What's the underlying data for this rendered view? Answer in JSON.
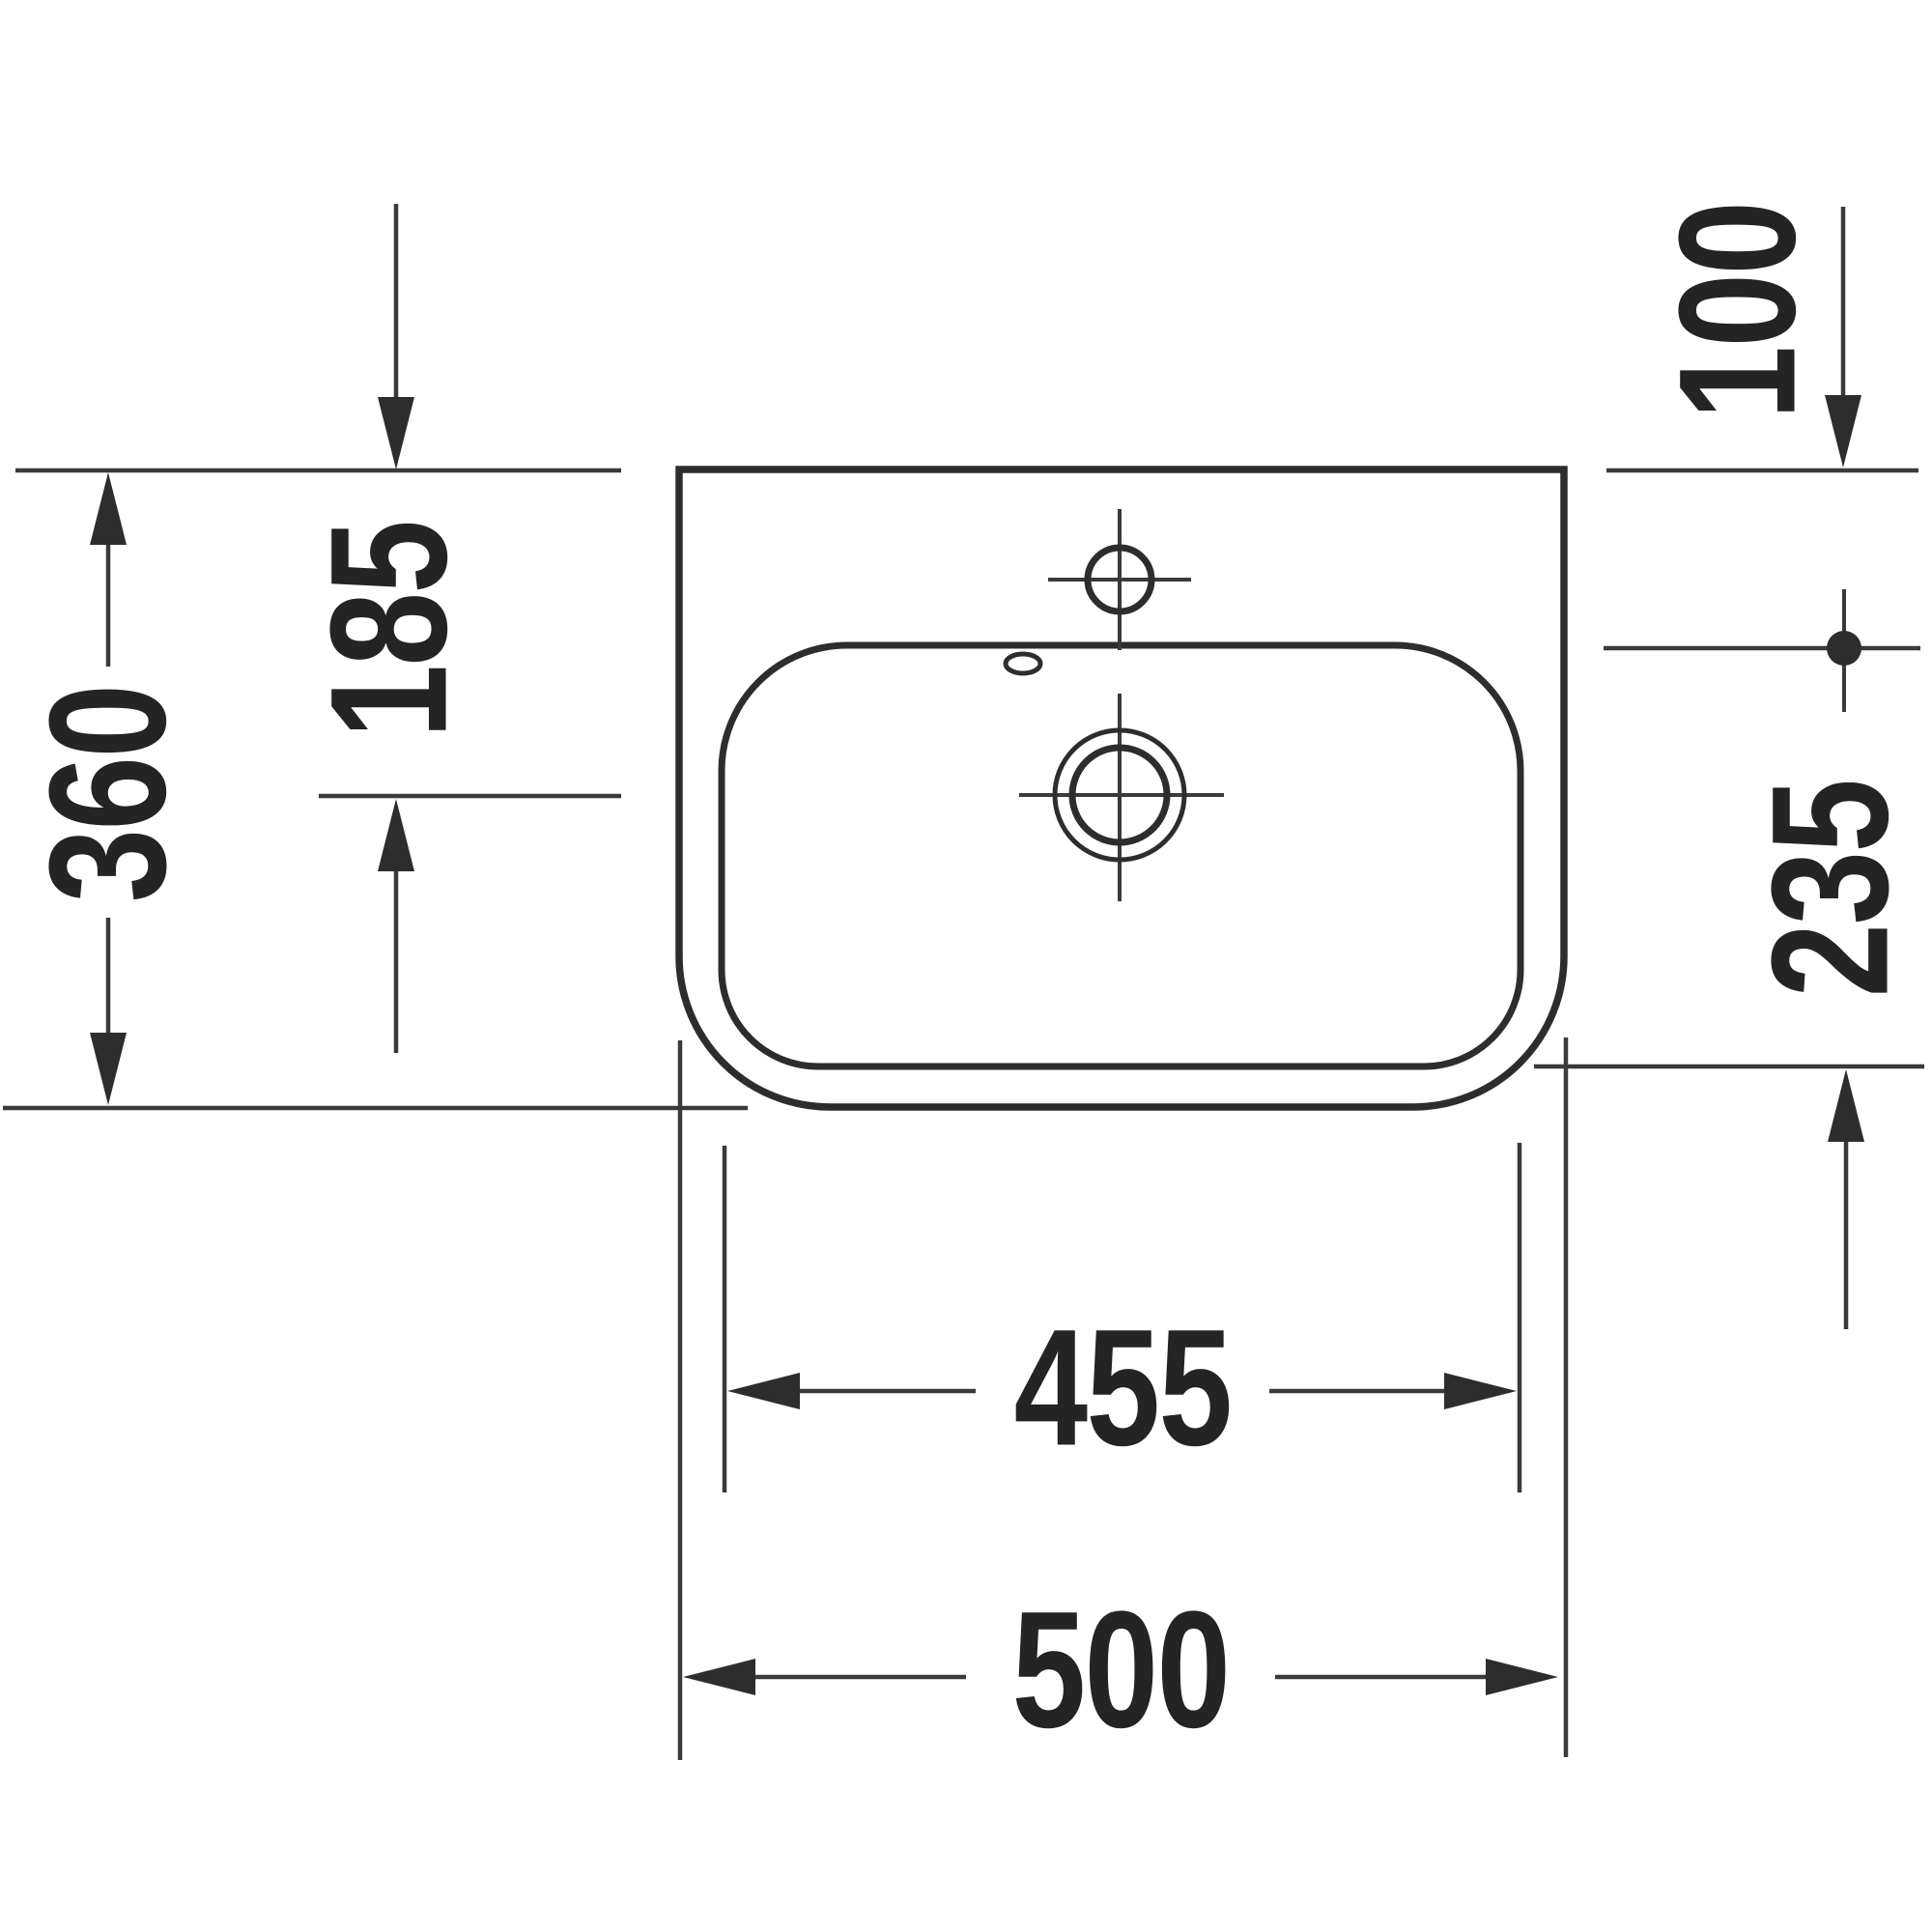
{
  "figure": {
    "background_color": "#ffffff",
    "line_color": "#2d2d2d",
    "labels": {
      "depth_overall": "360",
      "rear_to_drain": "185",
      "rear_to_bowl": "100",
      "bowl_depth": "235",
      "bowl_width": "455",
      "width_overall": "500"
    }
  }
}
